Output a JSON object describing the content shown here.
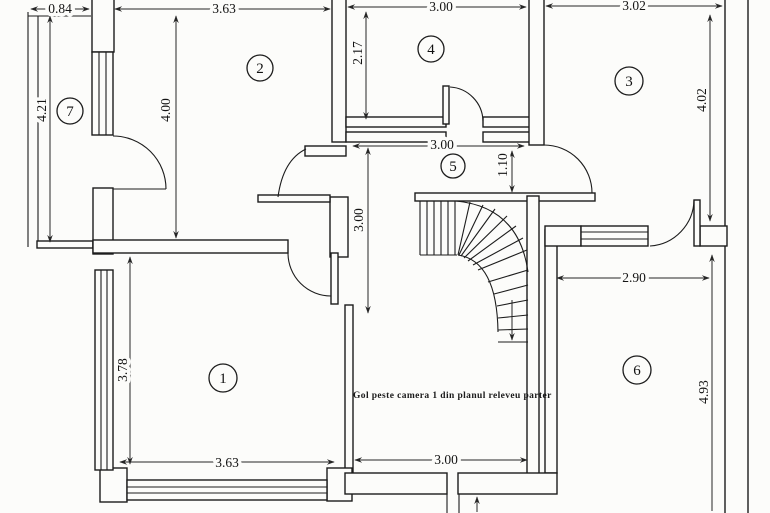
{
  "plan": {
    "note": "Gol peste camera 1 din planul releveu parter",
    "rooms": {
      "r1": "1",
      "r2": "2",
      "r3": "3",
      "r4": "4",
      "r5": "5",
      "r6": "6",
      "r7": "7"
    },
    "dims": {
      "top_balcony": "0.84",
      "top_room2": "3.63",
      "top_room4": "3.00",
      "top_room3": "3.02",
      "balcony_height": "4.21",
      "room2_height": "4.00",
      "room4_height": "2.17",
      "room3_height": "4.02",
      "hall_width": "3.00",
      "corridor_width": "1.10",
      "hall_height": "3.00",
      "room6_width": "2.90",
      "room1_height": "3.78",
      "room6_height": "4.93",
      "bottom_room1": "3.63",
      "bottom_hall": "3.00"
    },
    "ink_color": "#1c1c1c",
    "paper_color": "#fcfcfa"
  }
}
